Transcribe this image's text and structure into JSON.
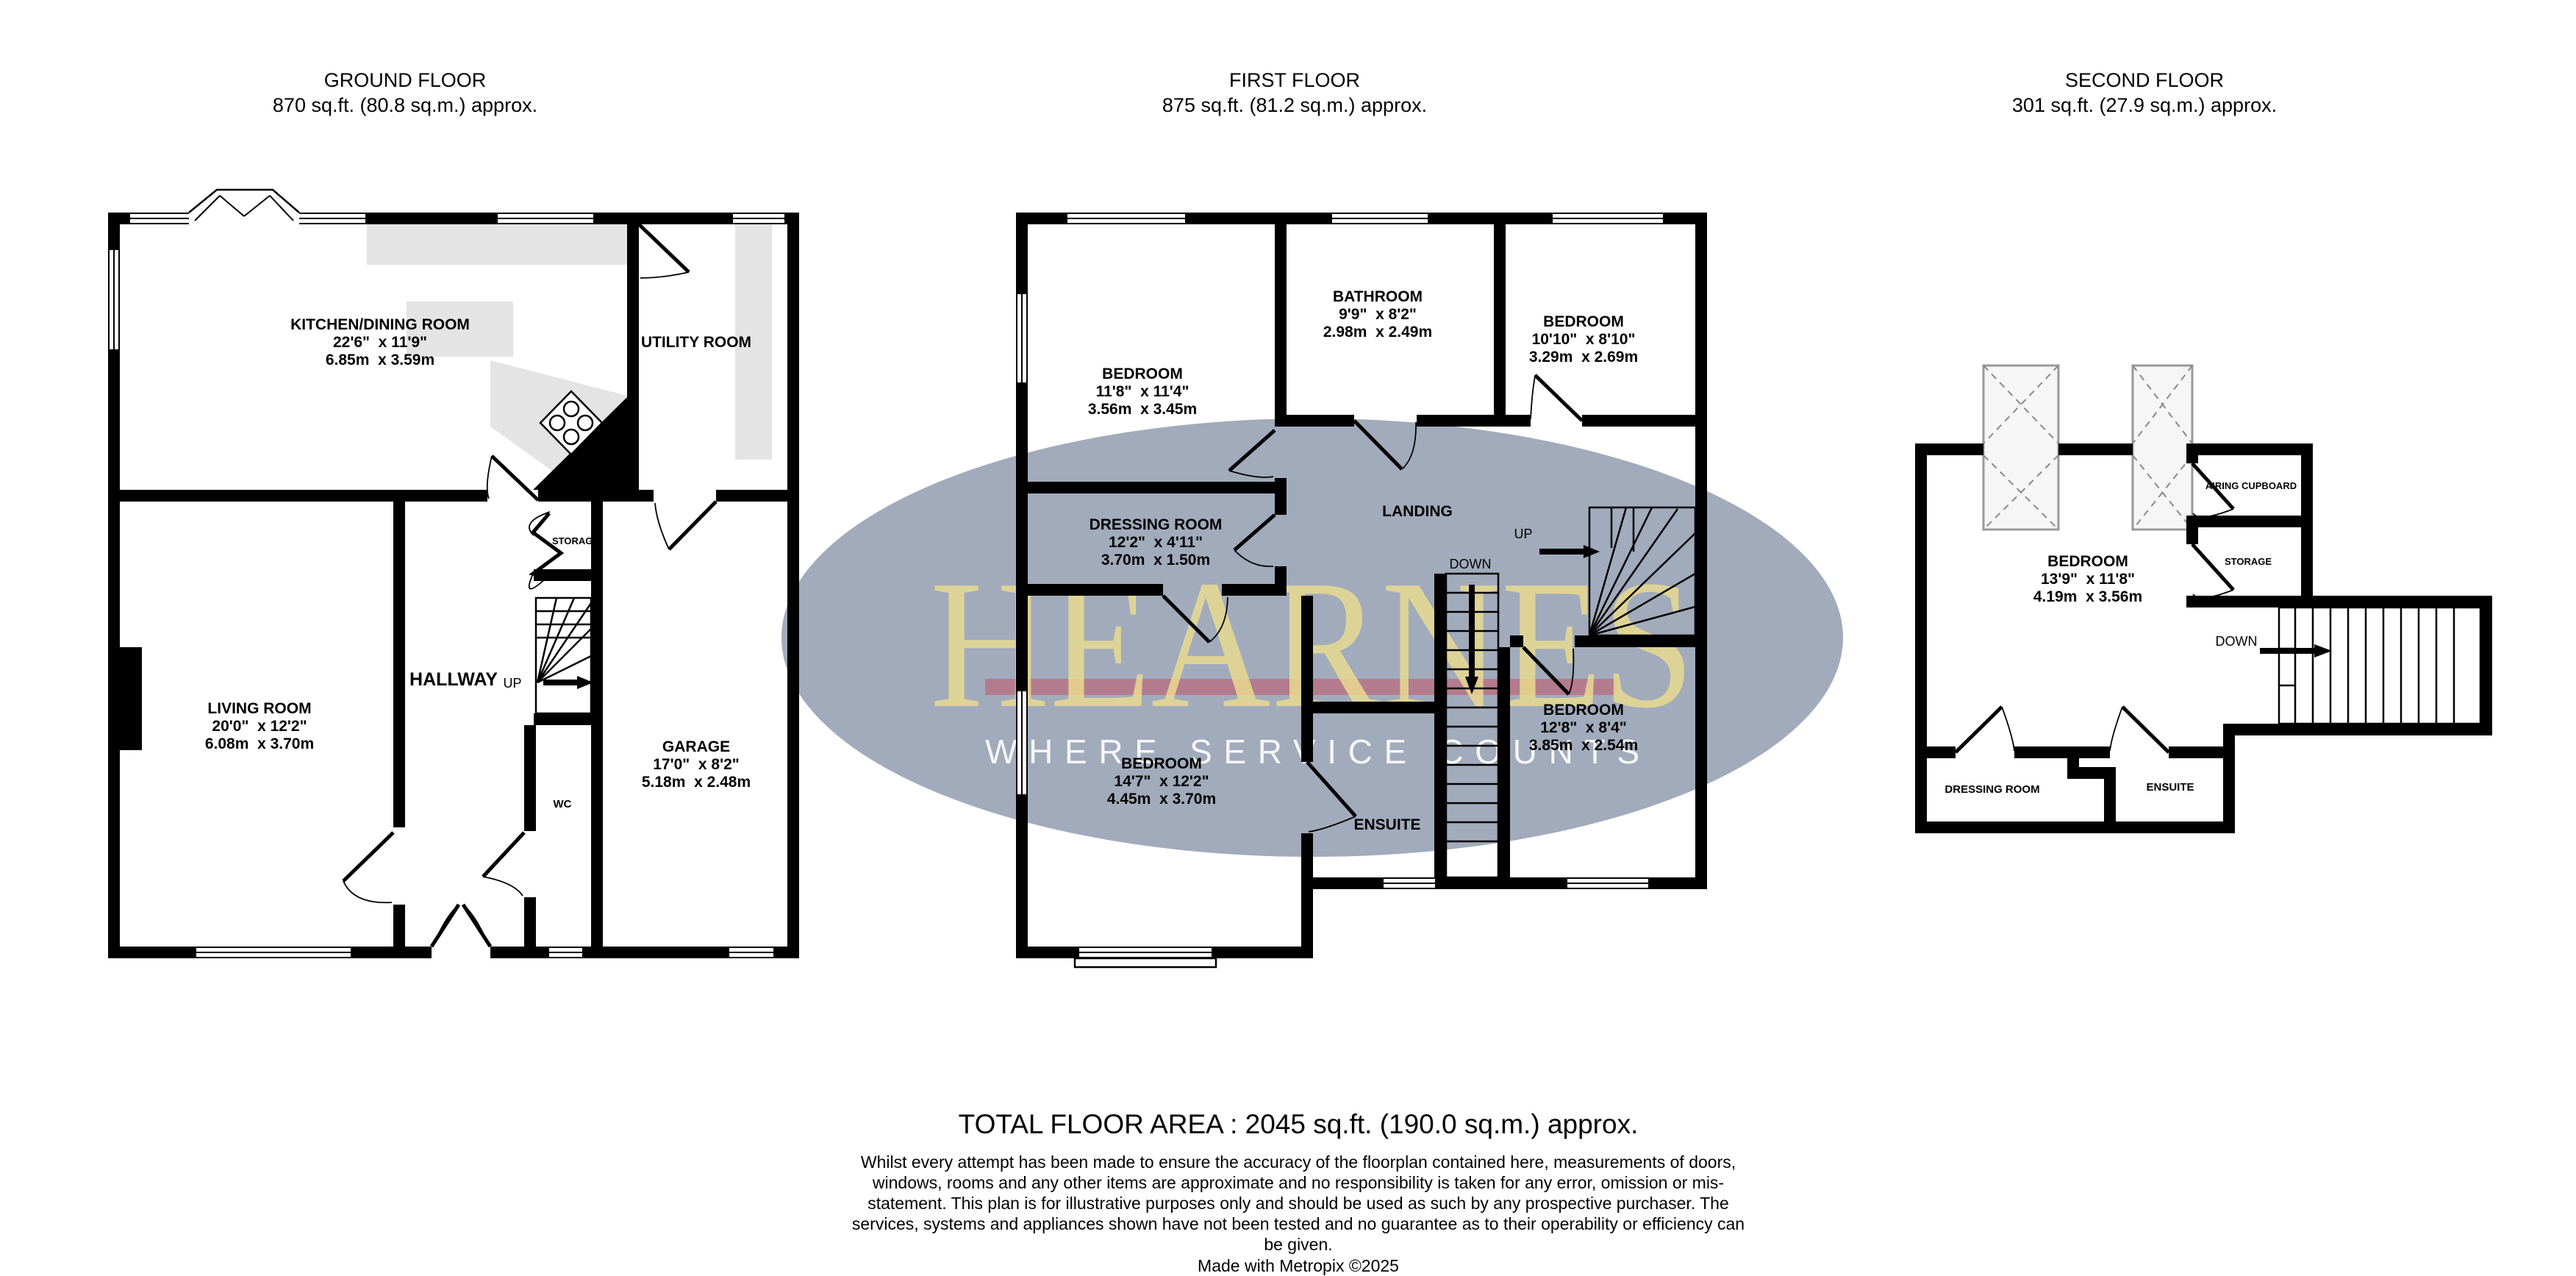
{
  "floors": {
    "ground": {
      "title": "GROUND FLOOR",
      "area": "870 sq.ft. (80.8 sq.m.) approx.",
      "rooms": {
        "kitchen": {
          "name": "KITCHEN/DINING ROOM",
          "imperial": "22'6\"  x 11'9\"",
          "metric": "6.85m  x 3.59m"
        },
        "utility": {
          "name": "UTILITY ROOM"
        },
        "living": {
          "name": "LIVING ROOM",
          "imperial": "20'0\"  x 12'2\"",
          "metric": "6.08m  x 3.70m"
        },
        "hallway": {
          "name": "HALLWAY"
        },
        "garage": {
          "name": "GARAGE",
          "imperial": "17'0\"  x 8'2\"",
          "metric": "5.18m  x 2.48m"
        },
        "wc": {
          "name": "WC"
        },
        "storage": {
          "name": "STORAGE"
        },
        "up": {
          "name": "UP"
        }
      }
    },
    "first": {
      "title": "FIRST FLOOR",
      "area": "875 sq.ft. (81.2 sq.m.) approx.",
      "rooms": {
        "bedroom1": {
          "name": "BEDROOM",
          "imperial": "11'8\"  x 11'4\"",
          "metric": "3.56m  x 3.45m"
        },
        "bathroom": {
          "name": "BATHROOM",
          "imperial": "9'9\"  x 8'2\"",
          "metric": "2.98m  x 2.49m"
        },
        "bedroom2": {
          "name": "BEDROOM",
          "imperial": "10'10\"  x 8'10\"",
          "metric": "3.29m  x 2.69m"
        },
        "dressing": {
          "name": "DRESSING ROOM",
          "imperial": "12'2\"  x 4'11\"",
          "metric": "3.70m  x 1.50m"
        },
        "landing": {
          "name": "LANDING"
        },
        "bedroom3": {
          "name": "BEDROOM",
          "imperial": "14'7\"  x 12'2\"",
          "metric": "4.45m  x 3.70m"
        },
        "bedroom4": {
          "name": "BEDROOM",
          "imperial": "12'8\"  x 8'4\"",
          "metric": "3.85m  x 2.54m"
        },
        "ensuite": {
          "name": "ENSUITE"
        },
        "up": {
          "name": "UP"
        },
        "down": {
          "name": "DOWN"
        }
      }
    },
    "second": {
      "title": "SECOND FLOOR",
      "area": "301 sq.ft. (27.9 sq.m.) approx.",
      "rooms": {
        "bedroom": {
          "name": "BEDROOM",
          "imperial": "13'9\"  x 11'8\"",
          "metric": "4.19m  x 3.56m"
        },
        "airing": {
          "name": "AIRING CUPBOARD"
        },
        "storage": {
          "name": "STORAGE"
        },
        "dressing": {
          "name": "DRESSING ROOM"
        },
        "ensuite": {
          "name": "ENSUITE"
        },
        "down": {
          "name": "DOWN"
        }
      }
    }
  },
  "watermark": {
    "brand": "HEARNES",
    "tagline": "WHERE SERVICE COUNTS",
    "ellipse_color": "#2f4469",
    "brand_color": "#e9d98f",
    "underline_color": "#c2556a",
    "tagline_color": "#ffffff"
  },
  "footer": {
    "total": "TOTAL FLOOR AREA : 2045 sq.ft. (190.0 sq.m.) approx.",
    "disclaimer": "Whilst every attempt has been made to ensure the accuracy of the floorplan contained here, measurements of doors, windows, rooms and any other items are approximate and no responsibility is taken for any error, omission or mis-statement. This plan is for illustrative purposes only and should be used as such by any prospective purchaser. The services, systems and appliances shown have not been tested and no guarantee as to their operability or efficiency can be given.",
    "credit": "Made with Metropix ©2025"
  }
}
